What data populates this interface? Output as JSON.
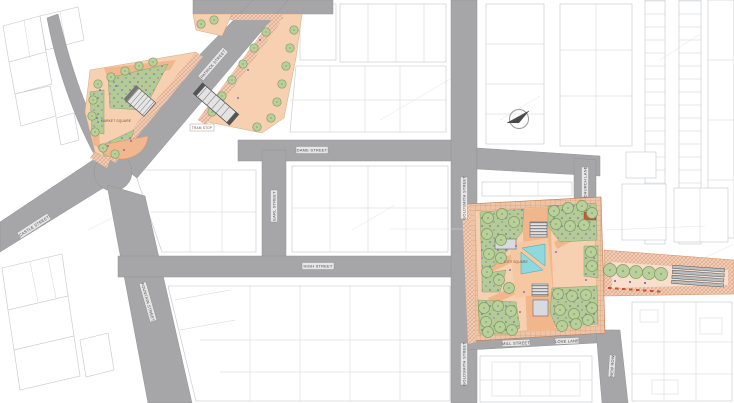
{
  "drawing": {
    "kind": "urban masterplan site plan",
    "street_labels": {
      "patrick": "PATRICK STREET",
      "dame": "DAME STREET",
      "earl": "EARL STREET",
      "high": "HIGH STREET",
      "castle": "CASTLE STREET",
      "fountain": "FOUNTAIN STREET",
      "goldsmith_upper": "GOLDSMITH STREET",
      "goldsmith_lower": "GOLDSMITH STREET",
      "church": "CHURCH LANE",
      "mill": "MILL STREET",
      "love": "LOVE LANE",
      "new_row": "NEW ROW"
    },
    "place_labels": {
      "plaza_left": "MARKET SQUARE",
      "plaza_right": "CITY SQUARE",
      "platform": "TRAM STOP"
    },
    "colors": {
      "street": "#a6a6a8",
      "paving": "#f6d0b0",
      "paving_accent": "#f2b68c",
      "lawn": "#b5cb96",
      "tree": "#b9d09c",
      "water": "#8fd8dc",
      "brick_hatch": "#d28a68",
      "building_line": "#bfc6cc"
    }
  }
}
